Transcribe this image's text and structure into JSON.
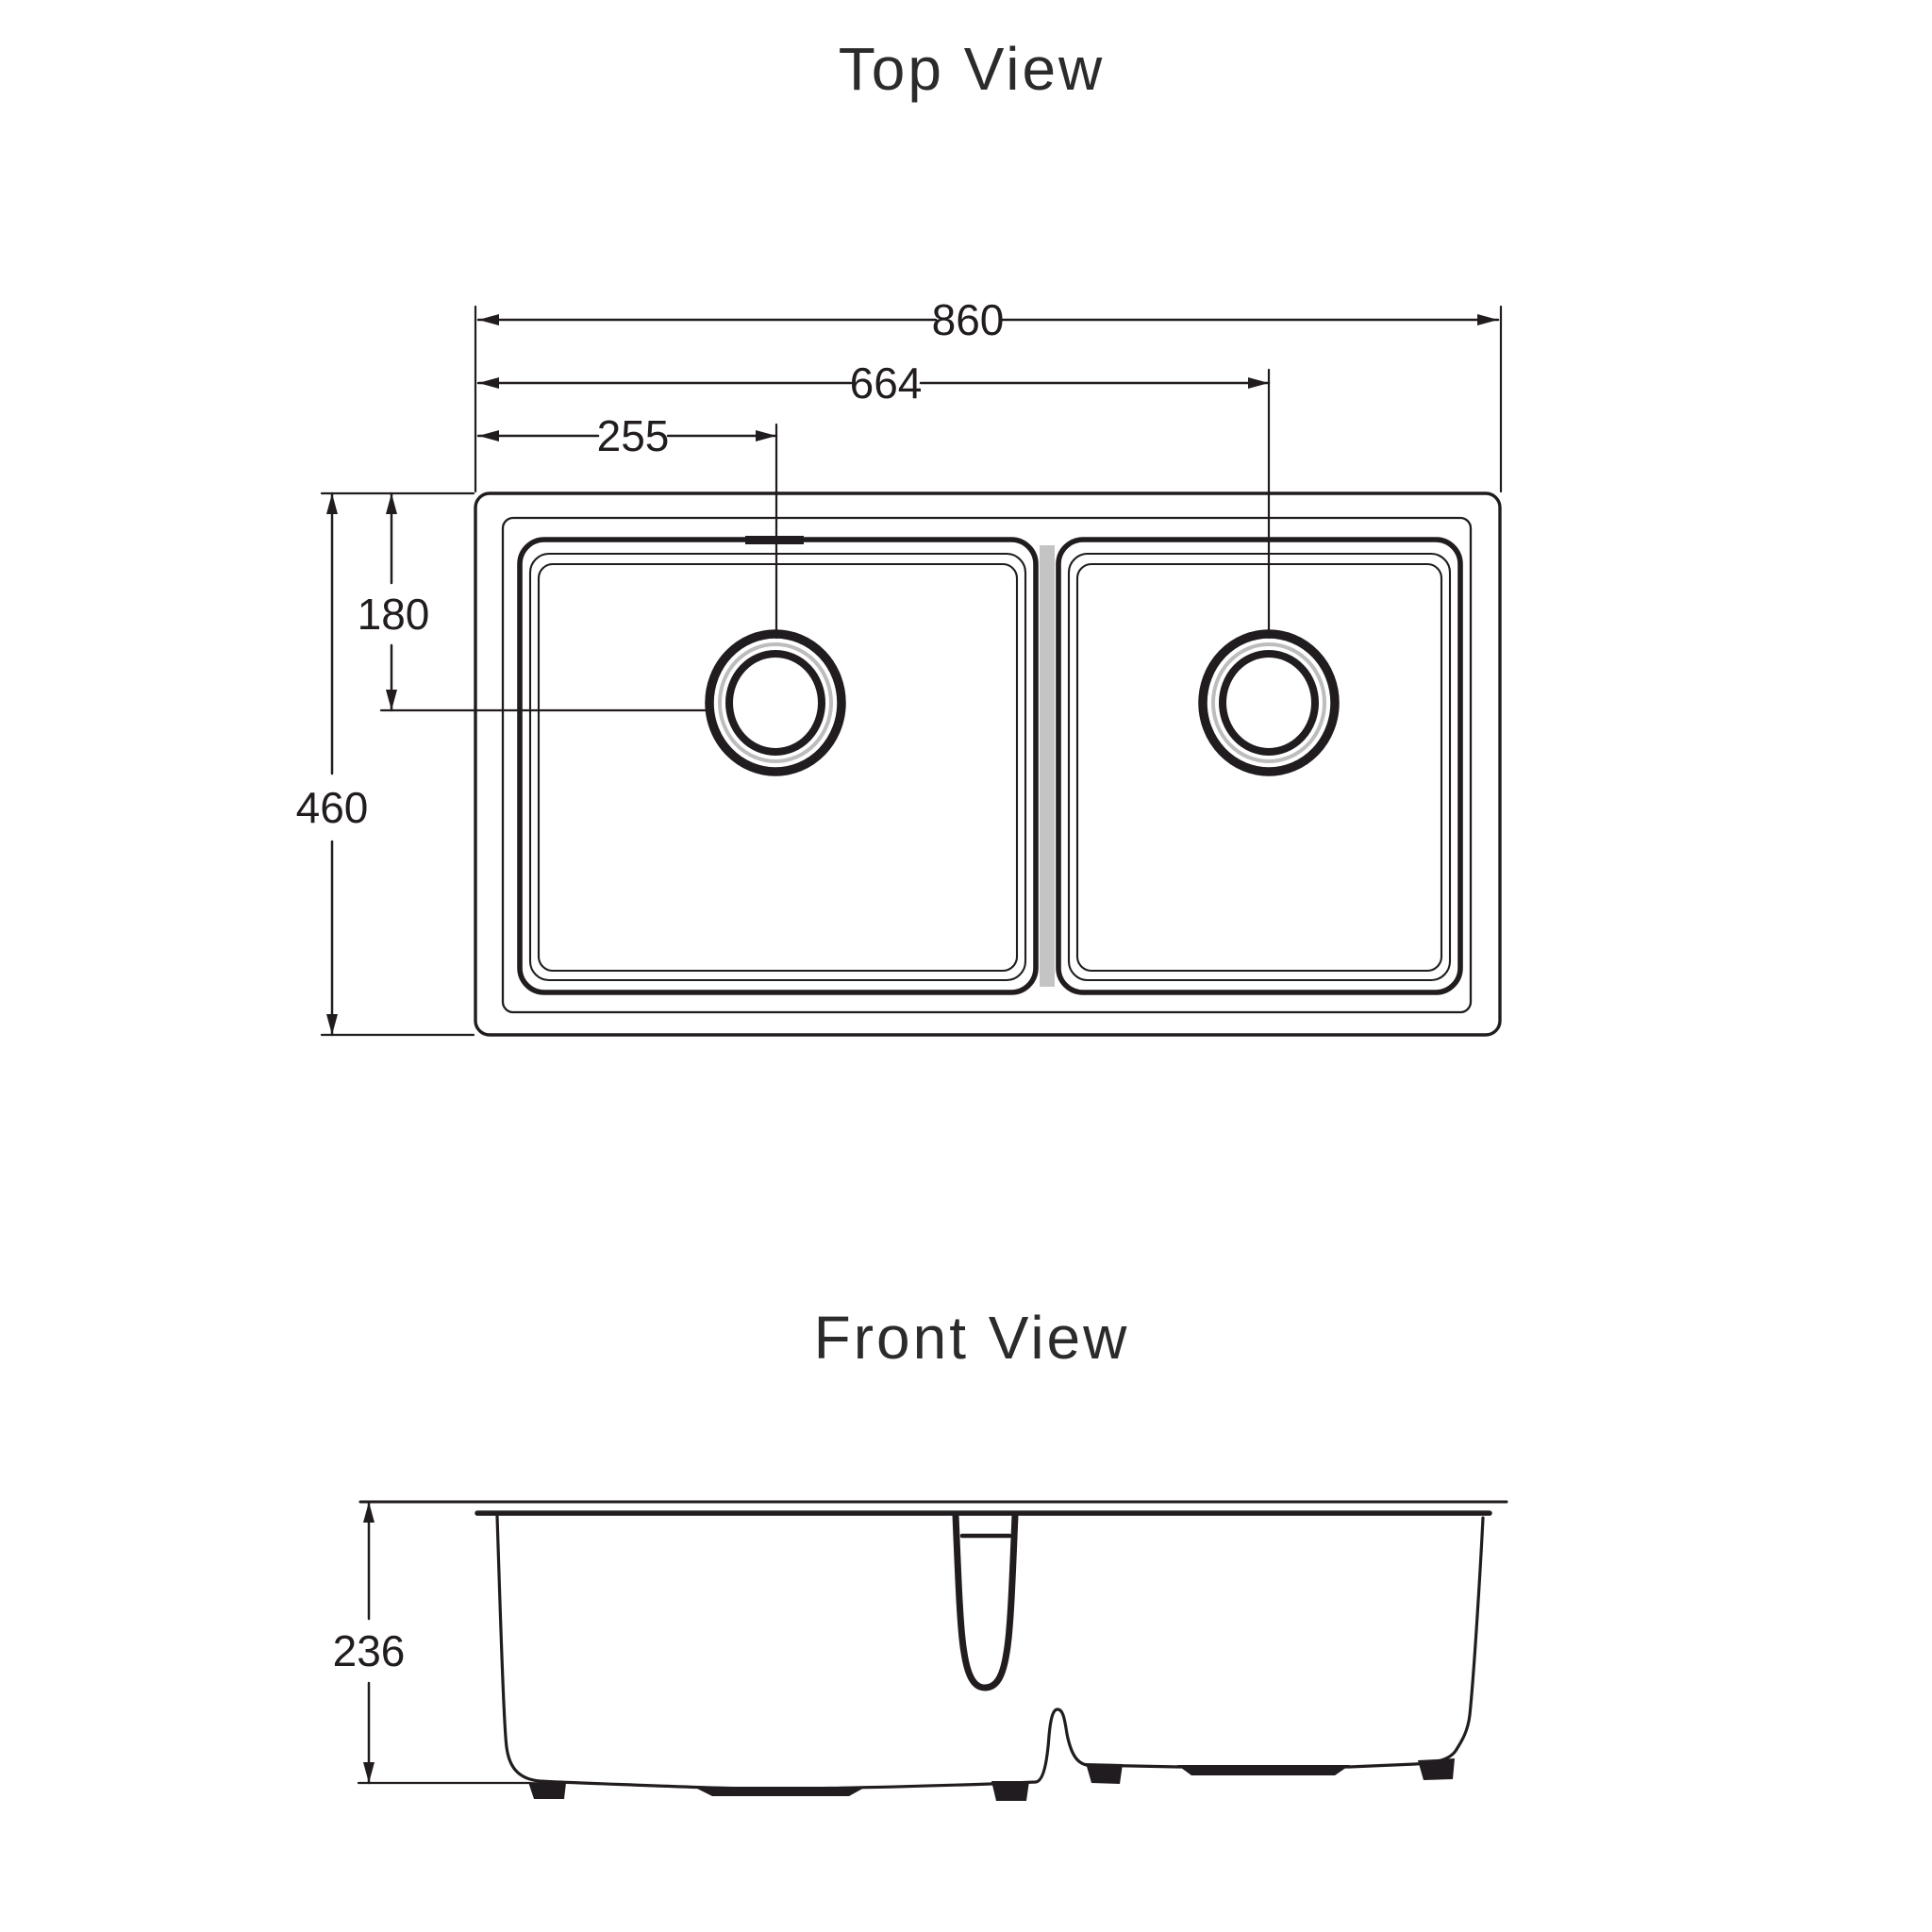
{
  "colors": {
    "line": "#211c1f",
    "title": "#2b2b2b",
    "divider_gray": "#c4c4c4",
    "drain_gray": "#bdbdbd",
    "background": "#ffffff"
  },
  "top_view": {
    "title": "Top View",
    "dims": {
      "overall_width": "860",
      "right_drain_offset": "664",
      "left_drain_offset": "255",
      "overall_depth": "460",
      "drain_center_depth": "180"
    }
  },
  "front_view": {
    "title": "Front View",
    "dims": {
      "overall_height": "236"
    }
  }
}
